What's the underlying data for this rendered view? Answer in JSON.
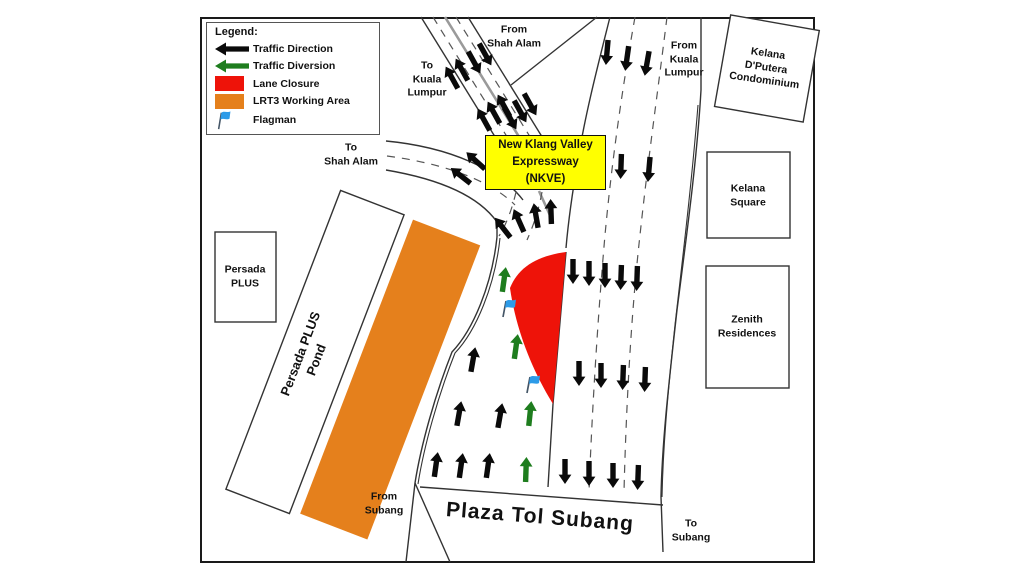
{
  "legend": {
    "title": "Legend:",
    "items": [
      {
        "name": "traffic-direction",
        "icon": "black-arrow-icon",
        "label": "Traffic Direction"
      },
      {
        "name": "traffic-diversion",
        "icon": "green-arrow-icon",
        "label": "Traffic Diversion"
      },
      {
        "name": "lane-closure",
        "icon": "red-swatch",
        "label": "Lane Closure"
      },
      {
        "name": "lrt3-working-area",
        "icon": "orange-swatch",
        "label": "LRT3 Working Area"
      },
      {
        "name": "flagman",
        "icon": "flag-icon",
        "label": "Flagman"
      }
    ]
  },
  "labels": {
    "to_kl": "To\nKuala\nLumpur",
    "from_shah_alam": "From\nShah Alam",
    "from_kl": "From\nKuala\nLumpur",
    "to_shah_alam": "To\nShah Alam",
    "kelana_dputera": "Kelana\nD'Putera\nCondominium",
    "kelana_square": "Kelana\nSquare",
    "zenith": "Zenith\nResidences",
    "persada_plus": "Persada\nPLUS",
    "pond": "Persada PLUS\nPond",
    "from_subang": "From\nSubang",
    "plaza": "Plaza Tol Subang",
    "to_subang": "To\nSubang",
    "nkve": "New Klang Valley\nExpressway\n(NKVE)"
  },
  "colors": {
    "traffic_black": "#0a0a0a",
    "diversion_green": "#1e7d1e",
    "lane_closure_red": "#ee1309",
    "working_area_orange": "#e5801c",
    "flag_blue": "#2d9be8",
    "nkve_yellow": "#ffff00"
  },
  "map": {
    "traffic_arrows": [
      {
        "x": 452,
        "y": 78,
        "r": -29
      },
      {
        "x": 462,
        "y": 70,
        "r": -29
      },
      {
        "x": 474,
        "y": 62,
        "r": 151
      },
      {
        "x": 485,
        "y": 54,
        "r": 151
      },
      {
        "x": 484,
        "y": 120,
        "r": -29
      },
      {
        "x": 494,
        "y": 113,
        "r": -29
      },
      {
        "x": 504,
        "y": 106,
        "r": -29
      },
      {
        "x": 510,
        "y": 118,
        "r": 151
      },
      {
        "x": 520,
        "y": 111,
        "r": 151
      },
      {
        "x": 530,
        "y": 104,
        "r": 151
      },
      {
        "x": 461,
        "y": 176,
        "r": -52
      },
      {
        "x": 476,
        "y": 161,
        "r": -48
      },
      {
        "x": 503,
        "y": 228,
        "r": -38
      },
      {
        "x": 519,
        "y": 221,
        "r": -24
      },
      {
        "x": 536,
        "y": 216,
        "r": -10
      },
      {
        "x": 551,
        "y": 212,
        "r": -2
      },
      {
        "x": 607,
        "y": 52,
        "r": 185
      },
      {
        "x": 627,
        "y": 58,
        "r": 188
      },
      {
        "x": 647,
        "y": 63,
        "r": 190
      },
      {
        "x": 621,
        "y": 166,
        "r": 182
      },
      {
        "x": 649,
        "y": 169,
        "r": 185
      },
      {
        "x": 573,
        "y": 271,
        "r": 180
      },
      {
        "x": 589,
        "y": 273,
        "r": 180
      },
      {
        "x": 605,
        "y": 275,
        "r": 180
      },
      {
        "x": 621,
        "y": 277,
        "r": 182
      },
      {
        "x": 637,
        "y": 278,
        "r": 182
      },
      {
        "x": 579,
        "y": 373,
        "r": 180
      },
      {
        "x": 601,
        "y": 375,
        "r": 180
      },
      {
        "x": 623,
        "y": 377,
        "r": 182
      },
      {
        "x": 645,
        "y": 379,
        "r": 182
      },
      {
        "x": 565,
        "y": 471,
        "r": 180
      },
      {
        "x": 589,
        "y": 473,
        "r": 180
      },
      {
        "x": 613,
        "y": 475,
        "r": 180
      },
      {
        "x": 638,
        "y": 477,
        "r": 182
      },
      {
        "x": 473,
        "y": 360,
        "r": 10
      },
      {
        "x": 459,
        "y": 414,
        "r": 10
      },
      {
        "x": 500,
        "y": 416,
        "r": 10
      },
      {
        "x": 436,
        "y": 465,
        "r": 8
      },
      {
        "x": 461,
        "y": 466,
        "r": 8
      },
      {
        "x": 488,
        "y": 466,
        "r": 8
      }
    ],
    "diversion_arrows": [
      {
        "x": 504,
        "y": 280,
        "r": 8
      },
      {
        "x": 516,
        "y": 347,
        "r": 8
      },
      {
        "x": 530,
        "y": 414,
        "r": 6
      },
      {
        "x": 526,
        "y": 470,
        "r": 2
      }
    ],
    "flagmen": [
      {
        "x": 505,
        "y": 308
      },
      {
        "x": 529,
        "y": 384
      }
    ]
  }
}
